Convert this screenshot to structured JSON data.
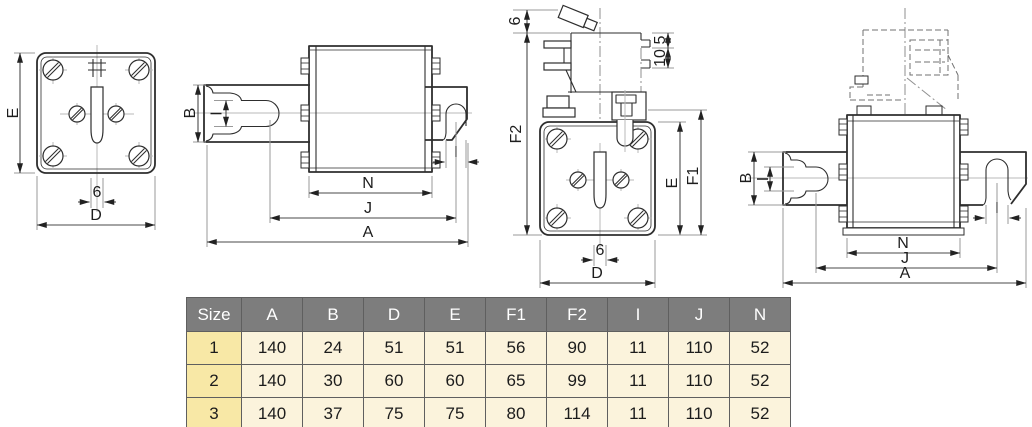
{
  "colors": {
    "background": "#ffffff",
    "drawing_line": "#2e2e2e",
    "dimension_line": "#4a4a4a",
    "extension_line": "#9a9a9a",
    "center_line": "#b8b8b8",
    "table_header_bg": "#7d7d7d",
    "table_header_text": "#ffffff",
    "table_size_col_bg": "#f8e8a6",
    "table_cell_bg": "#fbf3dc",
    "table_border": "#5f5f5f"
  },
  "drawings": {
    "front": {
      "e": "E",
      "slot": "6",
      "d": "D"
    },
    "top": {
      "b": "B",
      "i_left": "I",
      "i_right": "I",
      "n": "N",
      "j": "J",
      "a": "A"
    },
    "side": {
      "striker": "6",
      "f2": "F2",
      "step5": "5",
      "step10": "10",
      "e": "E",
      "f1": "F1",
      "slot": "6",
      "d": "D"
    },
    "switch_view": {
      "b": "B",
      "i_left": "I",
      "i_right": "I",
      "n": "N",
      "j": "J",
      "a": "A"
    }
  },
  "table": {
    "headers": [
      "Size",
      "A",
      "B",
      "D",
      "E",
      "F1",
      "F2",
      "I",
      "J",
      "N"
    ],
    "rows": [
      [
        "1",
        "140",
        "24",
        "51",
        "51",
        "56",
        "90",
        "11",
        "110",
        "52"
      ],
      [
        "2",
        "140",
        "30",
        "60",
        "60",
        "65",
        "99",
        "11",
        "110",
        "52"
      ],
      [
        "3",
        "140",
        "37",
        "75",
        "75",
        "80",
        "114",
        "11",
        "110",
        "52"
      ]
    ]
  }
}
